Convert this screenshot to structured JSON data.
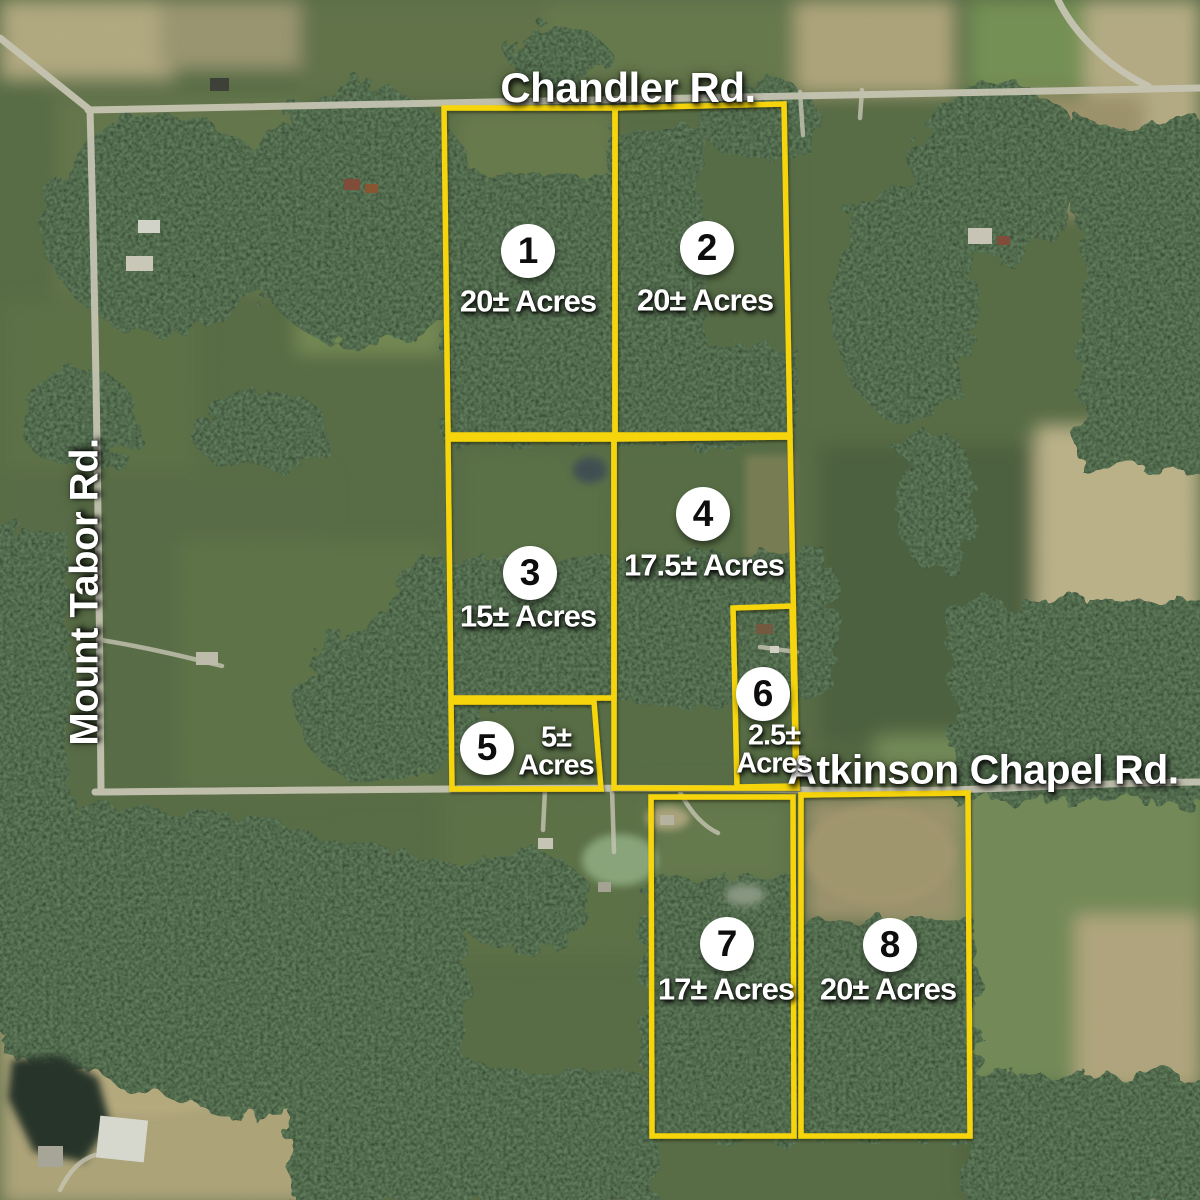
{
  "roads": {
    "top": "Chandler Rd.",
    "left": "Mount Tabor Rd.",
    "middle": "Atkinson Chapel Rd."
  },
  "parcels": [
    {
      "number": "1",
      "acres": "20± Acres"
    },
    {
      "number": "2",
      "acres": "20± Acres"
    },
    {
      "number": "3",
      "acres": "15± Acres"
    },
    {
      "number": "4",
      "acres": "17.5± Acres"
    },
    {
      "number": "5",
      "acres": "5±",
      "acres2": "Acres"
    },
    {
      "number": "6",
      "acres": "2.5±",
      "acres2": "Acres"
    },
    {
      "number": "7",
      "acres": "17± Acres"
    },
    {
      "number": "8",
      "acres": "20± Acres"
    }
  ],
  "colors": {
    "parcel_outline": "#F6D50B",
    "badge_fill": "#FFFFFF",
    "badge_text": "#0D0D0D",
    "label_text": "#FFFFFF"
  }
}
